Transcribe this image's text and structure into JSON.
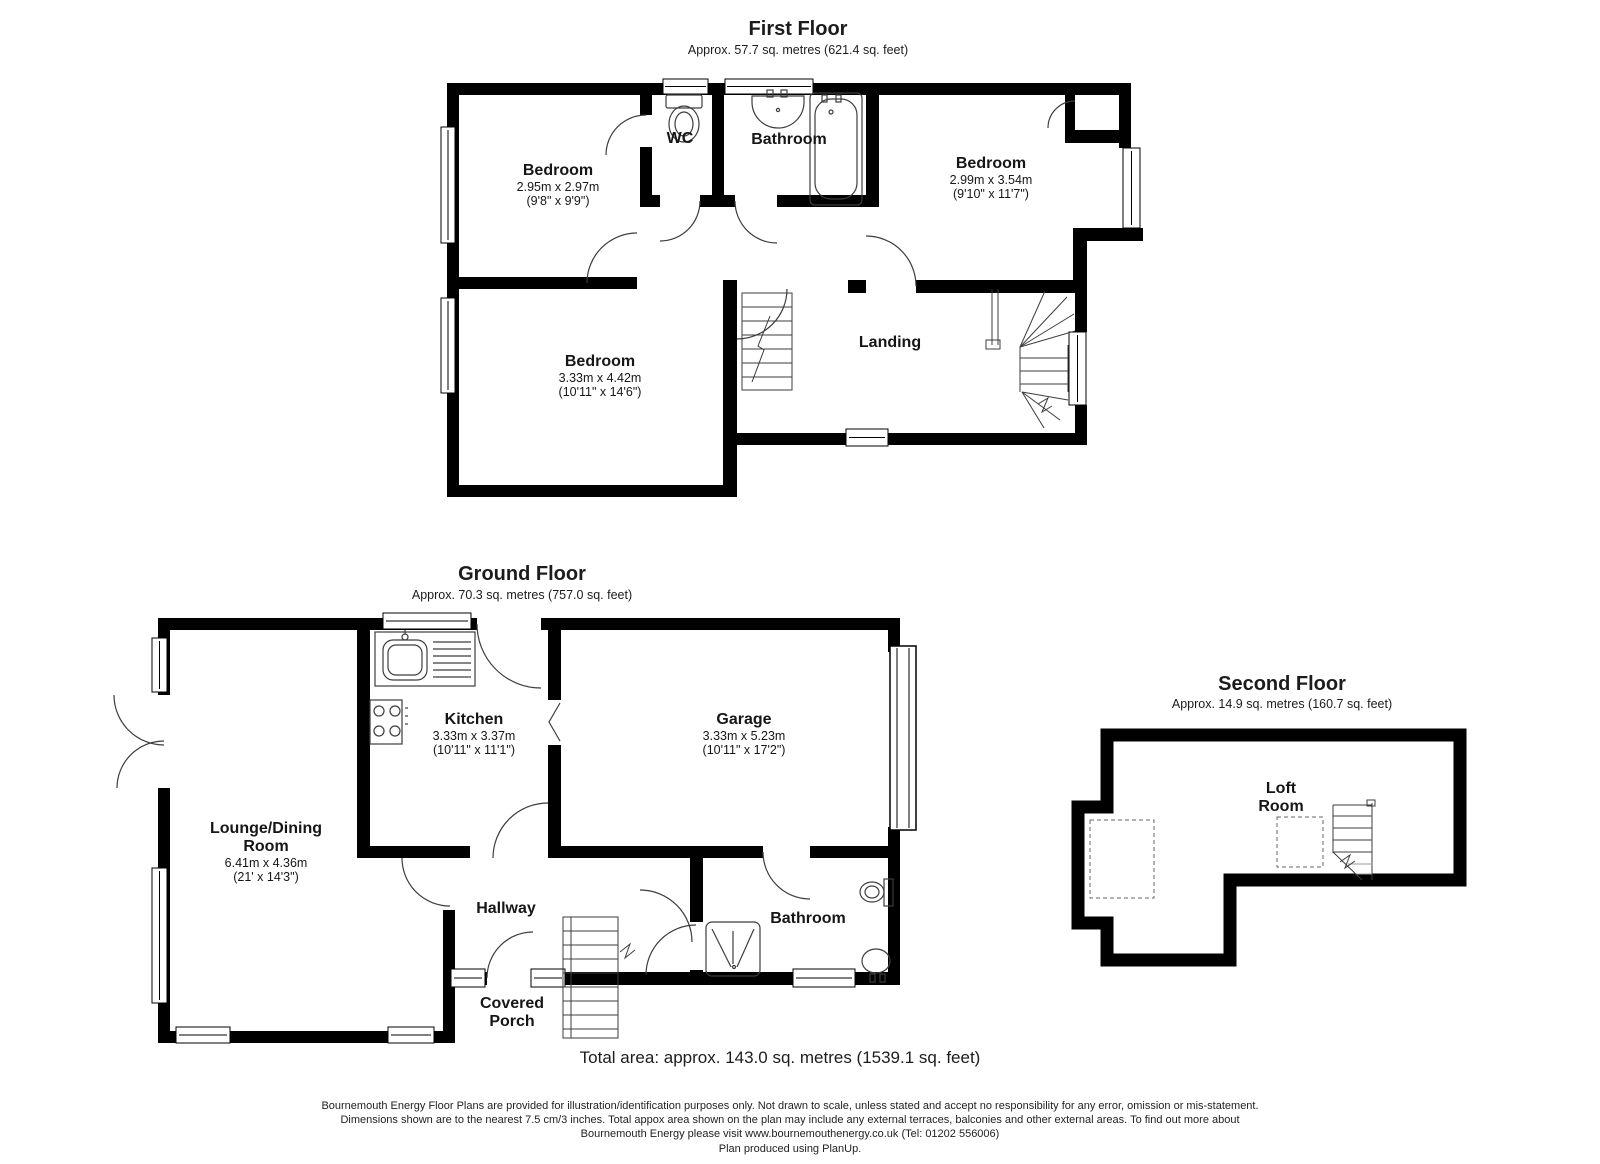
{
  "floors": {
    "first": {
      "title": "First Floor",
      "subtitle": "Approx. 57.7 sq. metres (621.4 sq. feet)"
    },
    "ground": {
      "title": "Ground Floor",
      "subtitle": "Approx. 70.3 sq. metres (757.0 sq. feet)"
    },
    "second": {
      "title": "Second Floor",
      "subtitle": "Approx. 14.9 sq. metres (160.7 sq. feet)"
    }
  },
  "rooms": {
    "ff_bedroom_left": {
      "name": "Bedroom",
      "metric": "2.95m x 2.97m",
      "imperial": "(9'8\" x 9'9\")"
    },
    "ff_wc": {
      "name": "WC"
    },
    "ff_bathroom": {
      "name": "Bathroom"
    },
    "ff_bedroom_right": {
      "name": "Bedroom",
      "metric": "2.99m x 3.54m",
      "imperial": "(9'10\" x 11'7\")"
    },
    "ff_bedroom_bottom": {
      "name": "Bedroom",
      "metric": "3.33m x 4.42m",
      "imperial": "(10'11\" x 14'6\")"
    },
    "ff_landing": {
      "name": "Landing"
    },
    "gf_kitchen": {
      "name": "Kitchen",
      "metric": "3.33m x 3.37m",
      "imperial": "(10'11\" x 11'1\")"
    },
    "gf_garage": {
      "name": "Garage",
      "metric": "3.33m x 5.23m",
      "imperial": "(10'11\" x 17'2\")"
    },
    "gf_lounge": {
      "name_line1": "Lounge/Dining",
      "name_line2": "Room",
      "metric": "6.41m x 4.36m",
      "imperial": "(21' x 14'3\")"
    },
    "gf_hallway": {
      "name": "Hallway"
    },
    "gf_bathroom": {
      "name": "Bathroom"
    },
    "gf_porch": {
      "name_line1": "Covered",
      "name_line2": "Porch"
    },
    "sf_loft": {
      "name_line1": "Loft",
      "name_line2": "Room"
    }
  },
  "total_area": "Total area: approx. 143.0 sq. metres (1539.1 sq. feet)",
  "disclaimer": {
    "line1": "Bournemouth Energy Floor Plans are provided for illustration/identification purposes only. Not drawn to scale, unless stated and accept no responsibility for any error, omission or mis-statement.",
    "line2": "Dimensions shown are to the nearest 7.5 cm/3 inches. Total appox area shown on the plan may include any external terraces, balconies and other external areas. To find out more about",
    "line3": "Bournemouth Energy please visit www.bournemouthenergy.co.uk (Tel: 01202 556006)",
    "line4": "Plan produced using PlanUp."
  },
  "colors": {
    "wall": "#000000",
    "line": "#3d3d3d",
    "background": "#ffffff"
  }
}
